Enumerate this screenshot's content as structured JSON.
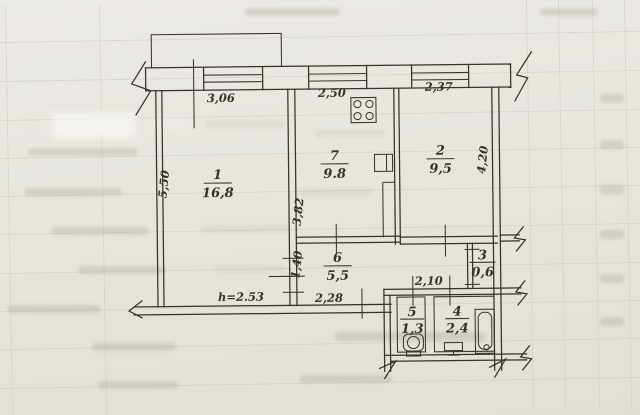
{
  "colors": {
    "paper": "#e8e5df",
    "ink": "#35322c",
    "grid": "#c8c4bb",
    "bleed": "#a49f94"
  },
  "rooms": [
    {
      "number": "1",
      "area": "16,8"
    },
    {
      "number": "7",
      "area": "9.8"
    },
    {
      "number": "2",
      "area": "9,5"
    },
    {
      "number": "6",
      "area": "5,5"
    },
    {
      "number": "3",
      "area": "0,6"
    },
    {
      "number": "5",
      "area": "1,3"
    },
    {
      "number": "4",
      "area": "2,4"
    }
  ],
  "dimensions": {
    "top_left": "3,06",
    "top_middle": "2,50",
    "top_right": "2,37",
    "left_wall": "5,50",
    "room1_kitchen_wall": "3,82",
    "right_wall": "4,20",
    "living_room_opening": "1,40",
    "hall_bottom": "2,28",
    "bath_hall_top": "2,10",
    "ceiling_height": "h=2.53"
  },
  "icons": {
    "stove": "gas-stove",
    "vent": "vent-shaft",
    "toilet": "toilet",
    "sink": "sink",
    "bathtub": "bathtub",
    "window": "window-glazing",
    "door": "door-opening-tick",
    "break": "wall-break-mark"
  }
}
